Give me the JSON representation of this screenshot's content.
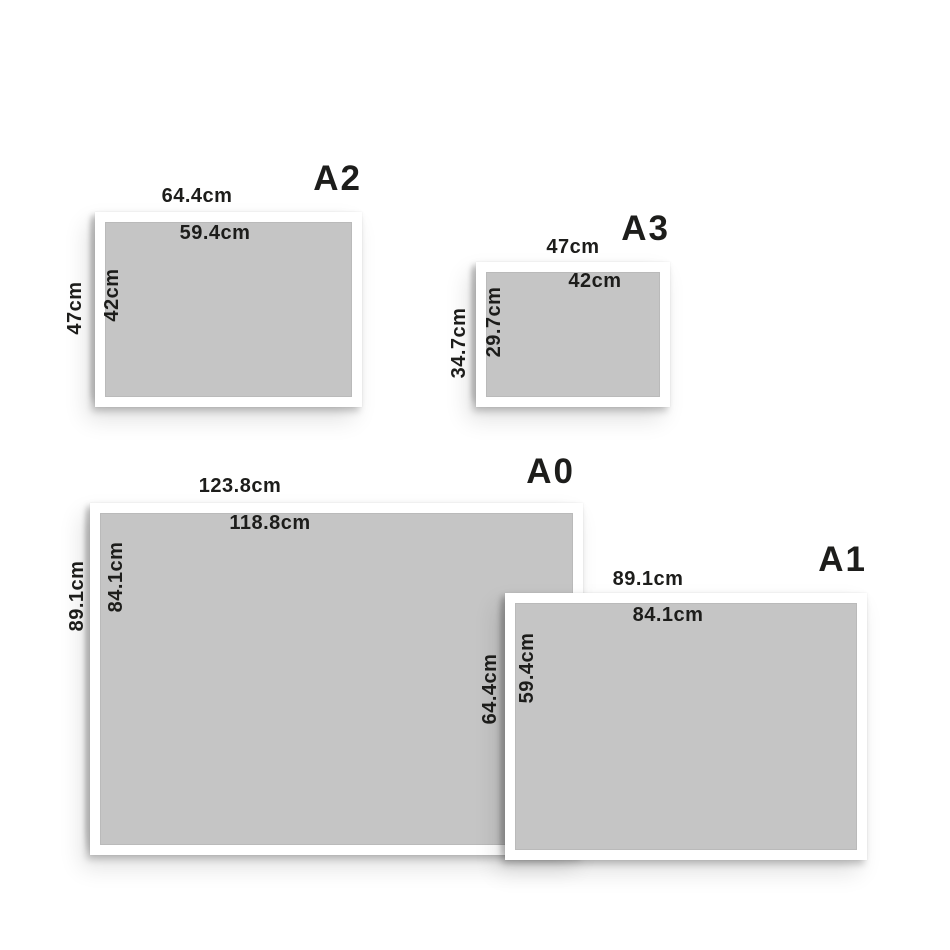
{
  "diagram": {
    "description": "Framed print size comparison of A-series paper sizes",
    "unit": "cm"
  },
  "papers": [
    {
      "name": "A2",
      "frame_width": "64.4cm",
      "print_width": "59.4cm",
      "frame_height": "47cm",
      "print_height": "42cm"
    },
    {
      "name": "A3",
      "frame_width": "47cm",
      "print_width": "42cm",
      "frame_height": "34.7cm",
      "print_height": "29.7cm"
    },
    {
      "name": "A0",
      "frame_width": "123.8cm",
      "print_width": "118.8cm",
      "frame_height": "89.1cm",
      "print_height": "84.1cm"
    },
    {
      "name": "A1",
      "frame_width": "89.1cm",
      "print_width": "84.1cm",
      "frame_height": "64.4cm",
      "print_height": "59.4cm"
    }
  ],
  "colors": {
    "paper_fill": "#c5c5c5",
    "frame_fill": "#ffffff",
    "text_color": "#1d1d1b",
    "background": "#ffffff"
  }
}
